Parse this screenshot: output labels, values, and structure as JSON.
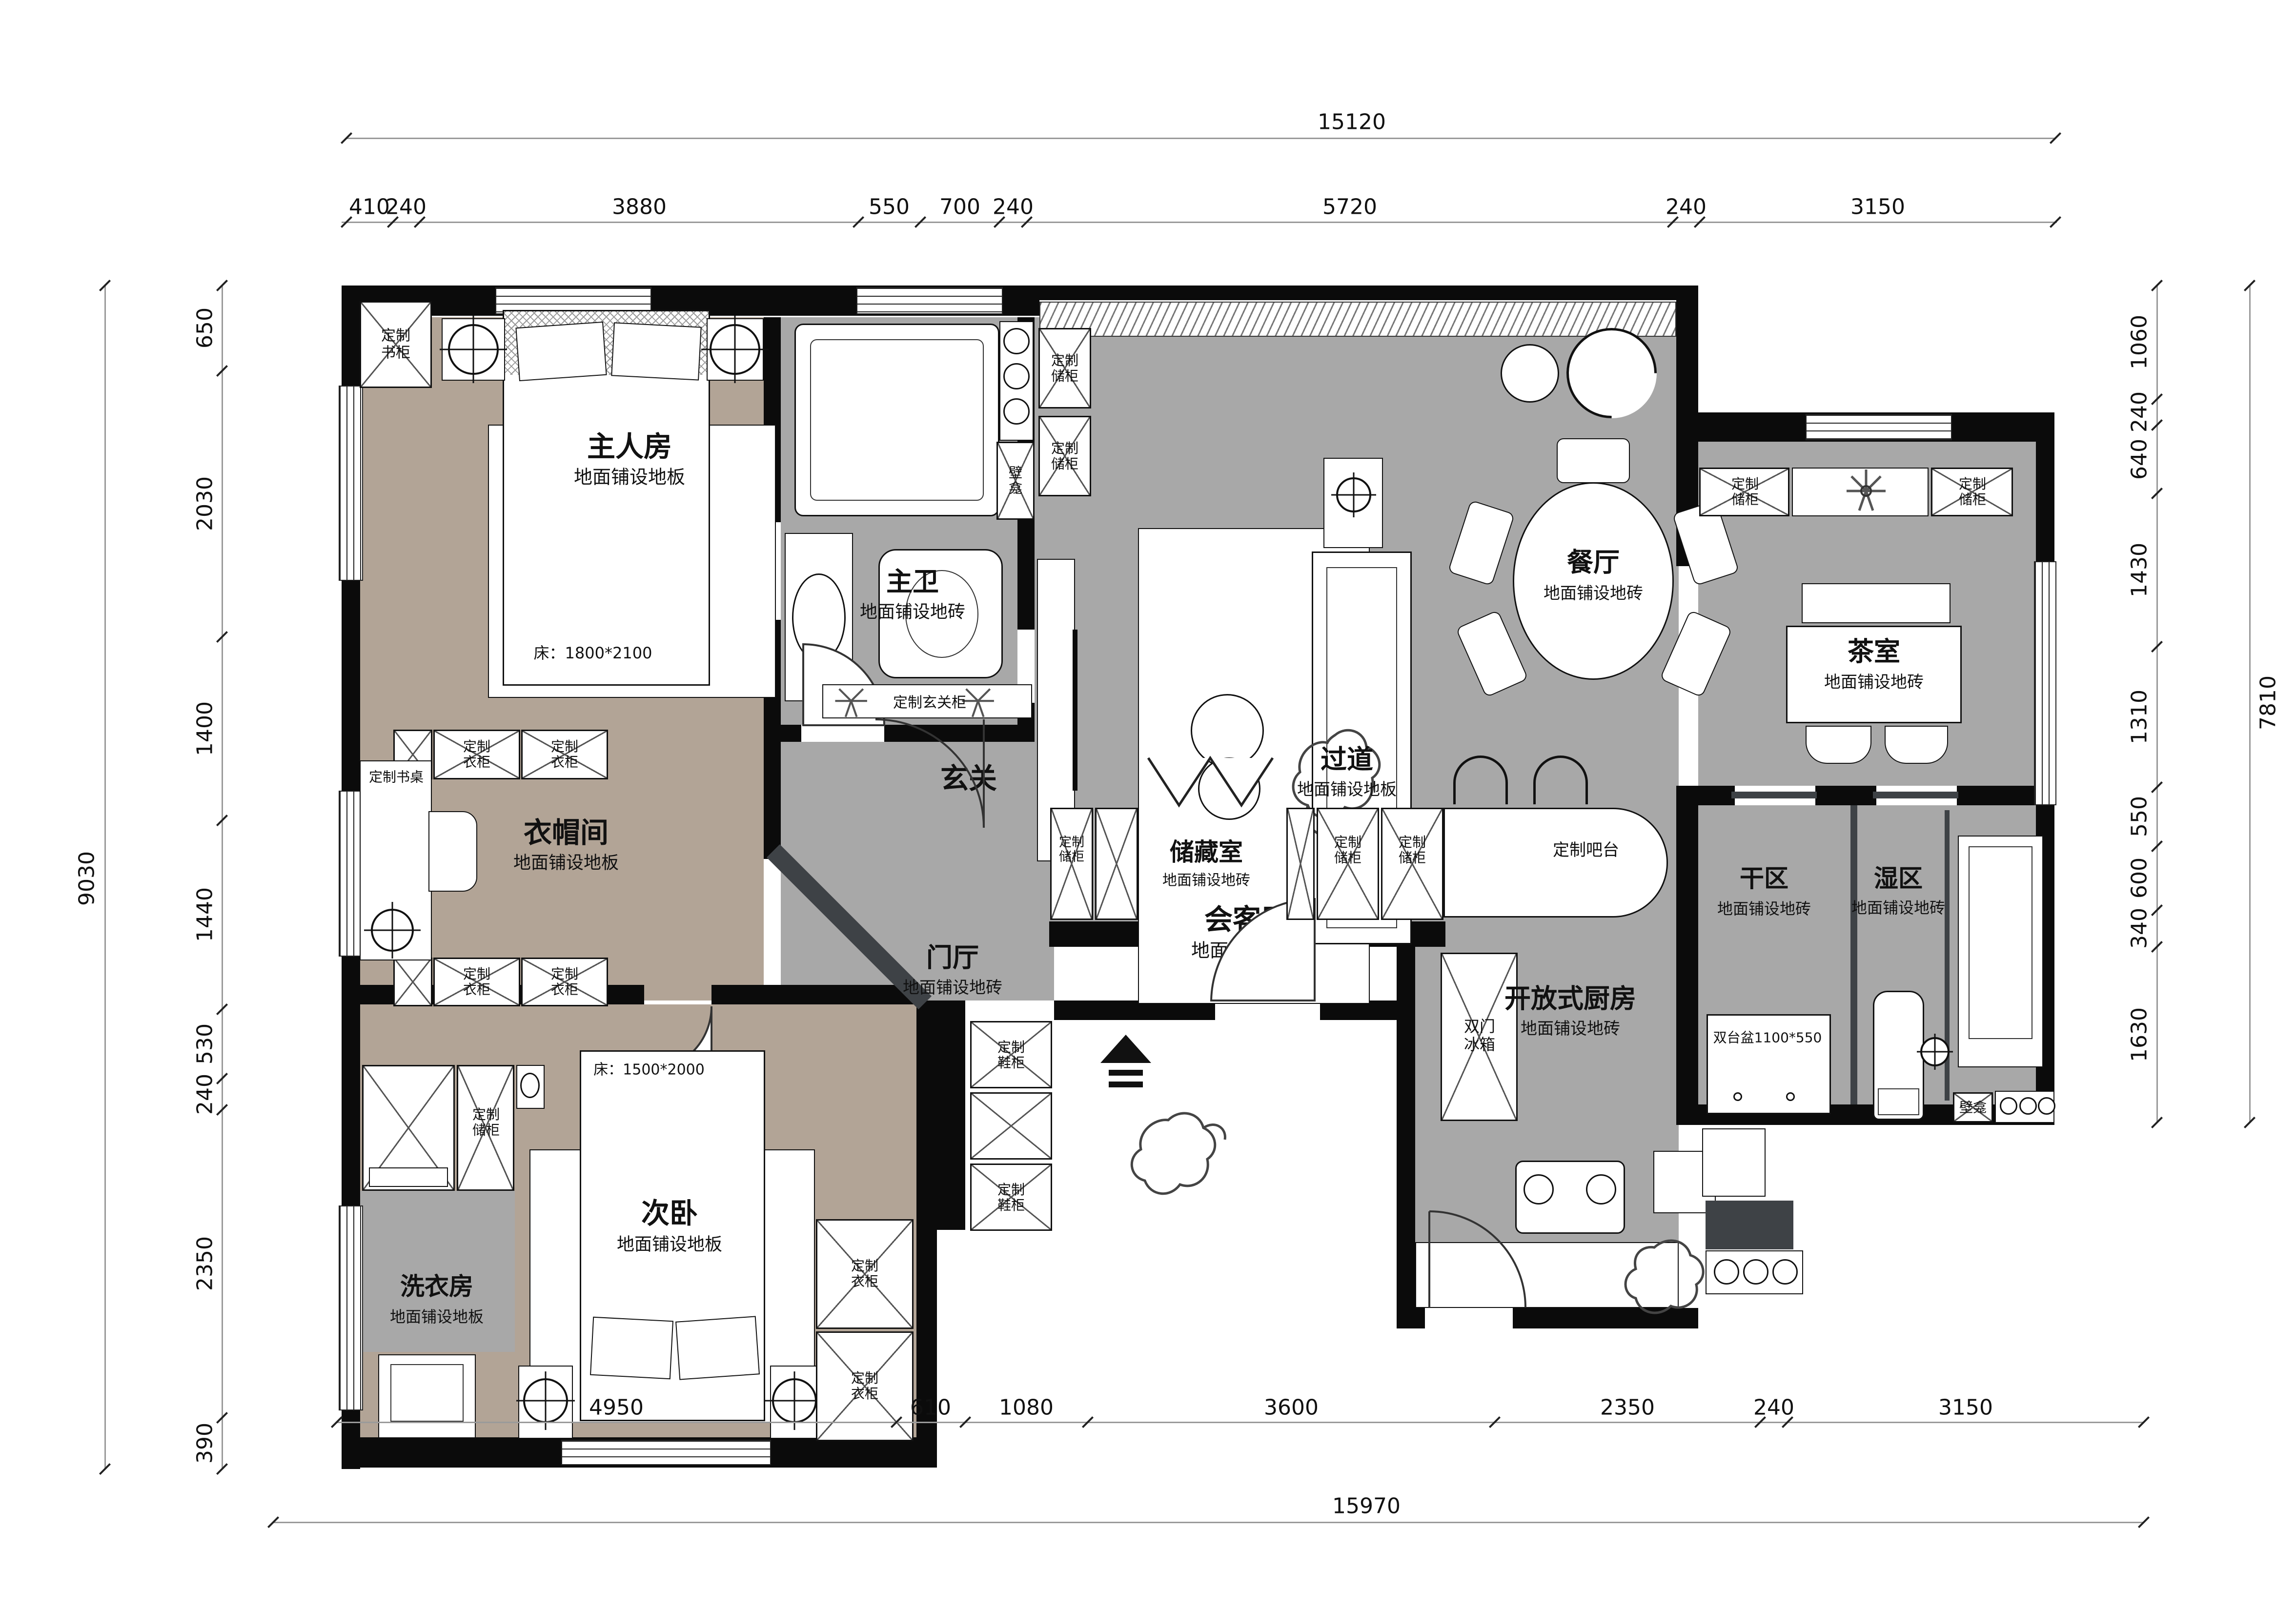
{
  "dimensions": {
    "top": {
      "total": "15120",
      "segments": [
        "410",
        "240",
        "3880",
        "550",
        "700",
        "240",
        "5720",
        "240",
        "3150"
      ]
    },
    "bottom": {
      "total": "15970",
      "segments": [
        "4950",
        "610",
        "1080",
        "3600",
        "2350",
        "240",
        "3150"
      ]
    },
    "left": {
      "total": "9030",
      "segments": [
        "650",
        "2030",
        "1400",
        "1440",
        "530",
        "240",
        "2350",
        "390"
      ]
    },
    "right": {
      "total": "7810",
      "segments": [
        "1060",
        "240",
        "640",
        "1430",
        "1310",
        "550",
        "600",
        "340",
        "1630"
      ]
    }
  },
  "rooms": {
    "master_bedroom": {
      "name": "主人房",
      "floor": "地面铺设地板",
      "bed_note": "床：1800*2100"
    },
    "master_bath": {
      "name": "主卫",
      "floor": "地面铺设地砖"
    },
    "living": {
      "name": "会客厅",
      "floor": "地面铺设地砖"
    },
    "dining": {
      "name": "餐厅",
      "floor": "地面铺设地砖"
    },
    "tea_room": {
      "name": "茶室",
      "floor": "地面铺设地砖"
    },
    "entry": {
      "name": "玄关"
    },
    "foyer": {
      "name": "门厅",
      "floor": "地面铺设地砖"
    },
    "hallway": {
      "name": "过道",
      "floor": "地面铺设地板"
    },
    "cloakroom": {
      "name": "衣帽间",
      "floor": "地面铺设地板"
    },
    "storage_room": {
      "name": "储藏室",
      "floor": "地面铺设地砖"
    },
    "open_kitchen": {
      "name": "开放式厨房",
      "floor": "地面铺设地砖"
    },
    "dry_zone": {
      "name": "干区",
      "floor": "地面铺设地砖"
    },
    "wet_zone": {
      "name": "湿区",
      "floor": "地面铺设地砖"
    },
    "laundry": {
      "name": "洗衣房",
      "floor": "地面铺设地板"
    },
    "second_bedroom": {
      "name": "次卧",
      "floor": "地面铺设地板",
      "bed_note": "床：1500*2000"
    }
  },
  "fixtures": {
    "custom_bookcase": "定制书柜",
    "custom_wardrobe": "定制衣柜",
    "custom_storage_cabinet": "定制储柜",
    "custom_desk": "定制书桌",
    "custom_entry_cabinet": "定制玄关柜",
    "custom_shoe_cabinet": "定制鞋柜",
    "custom_bar": "定制吧台",
    "double_door_fridge": "双门冰箱",
    "double_basin": "双台盆1100*550",
    "niche": "壁龛"
  },
  "colors": {
    "wood_floor": "#b2a496",
    "tile_floor": "#a8a8a8",
    "wall": "#0b0b0b",
    "accent_wall": "#3e4246"
  }
}
